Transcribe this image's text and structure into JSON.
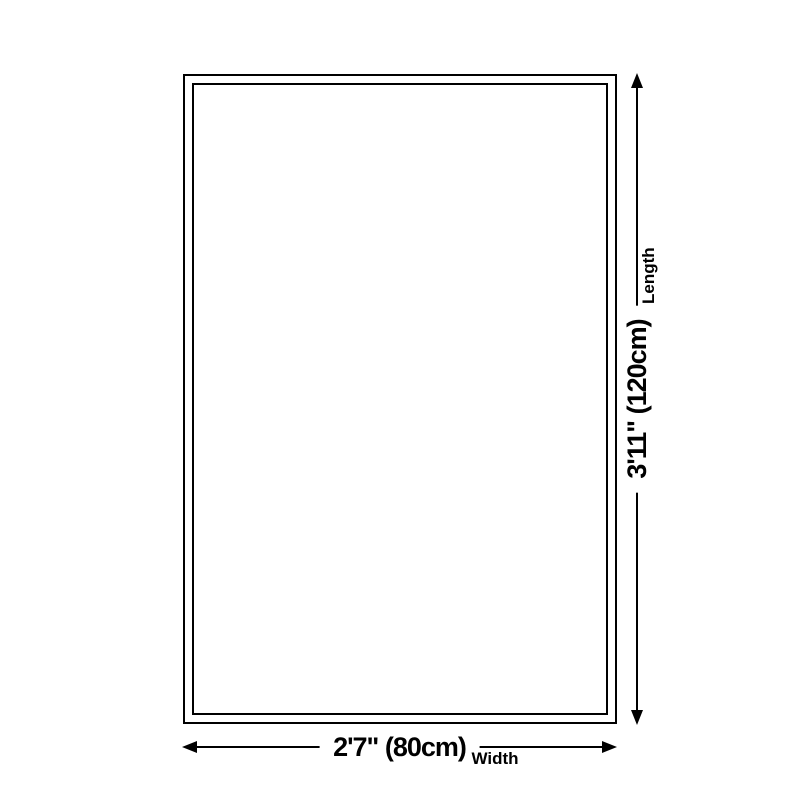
{
  "diagram": {
    "length": {
      "value": "3'11\" (120cm)",
      "label": "Length"
    },
    "width": {
      "value": "2'7\" (80cm)",
      "label": "Width"
    }
  },
  "colors": {
    "line": "#000000",
    "background": "#ffffff"
  }
}
